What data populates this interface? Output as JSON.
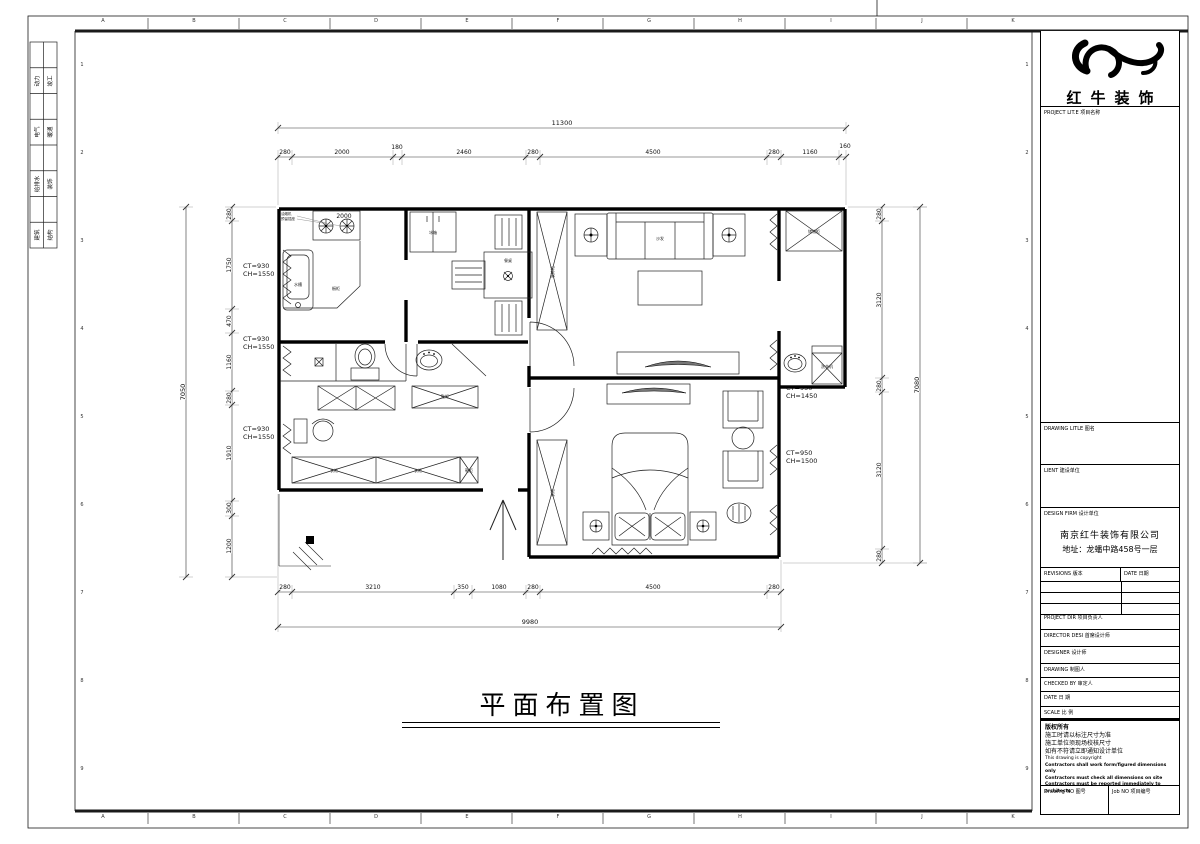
{
  "sheet": {
    "grid_letters": [
      "A",
      "B",
      "C",
      "D",
      "E",
      "F",
      "G",
      "H",
      "I",
      "J",
      "K"
    ],
    "grid_numbers": [
      "1",
      "2",
      "3",
      "4",
      "5",
      "6",
      "7",
      "8",
      "9"
    ],
    "disciplines": [
      {
        "a": "动力",
        "b": "竣工"
      },
      {
        "a": "电气",
        "b": "暖通"
      },
      {
        "a": "给排水",
        "b": "装饰"
      },
      {
        "a": "建筑",
        "b": "结构"
      }
    ]
  },
  "title_block": {
    "company_name": "红牛装饰",
    "project_label": "PROJECT LIT.E  项目名称",
    "drawing_title_label": "DRAWING LITLE  图名",
    "client_label": "LIENT  建设单位",
    "design_firm_label": "DESIGN FIRM  设计单位",
    "firm_name": "南京红牛装饰有限公司",
    "firm_address": "地址：龙蟠中路458号一层",
    "revisions_label": "REVISIONS  版本",
    "revisions_date_label": "DATE  日期",
    "project_dir_label": "PROJECT DIR  项目负责人",
    "director_label": "DIRECTOR DESI  首席设计师",
    "designer_label": "DESIGNER    设计师",
    "drawing_by_label": "DRAWING    制图人",
    "checked_by_label": "CHECKED BY   审定人",
    "date_label": "DATE      日  期",
    "scale_label": "SCALE     比  例",
    "copyright_lines": [
      "版权所有",
      "施工时请以标注尺寸为准",
      "施工单位须现场校核尺寸",
      "如有不符请立即通知设计单位",
      "This drawing is copyright",
      "Contractors shall work form/figured dimensions only",
      "Contractors must check all dimensions on site",
      "Contractors must be reported immediately to architects"
    ],
    "drawing_no_label": "Drawing NO  图号",
    "job_no_label": "Job NO  项目编号"
  },
  "plan": {
    "title": "平面布置图",
    "dims": {
      "top_overall": "11300",
      "top": [
        "280",
        "2000",
        "180",
        "2460",
        "280",
        "4500",
        "280",
        "1160",
        "160"
      ],
      "bottom": [
        "280",
        "3210",
        "350",
        "1080",
        "280",
        "4500",
        "280"
      ],
      "bottom_overall": "9980",
      "left": [
        "280",
        "1750",
        "470",
        "1160",
        "280",
        "1910",
        "300",
        "1200"
      ],
      "left_overall": "7050",
      "right": [
        "280",
        "3120",
        "280",
        "3120",
        "280"
      ],
      "right_overall": "7080",
      "kitchen_counter": "2000"
    },
    "window_tags": [
      {
        "ct": "CT=930",
        "ch": "CH=1550"
      },
      {
        "ct": "CT=930",
        "ch": "CH=1550"
      },
      {
        "ct": "CT=930",
        "ch": "CH=1550"
      },
      {
        "ct": "CT=950",
        "ch": "CH=1450"
      },
      {
        "ct": "CT=950",
        "ch": "CH=1500"
      }
    ],
    "labels": {
      "fridge": "冰箱",
      "dining_table": "餐桌",
      "sofa": "沙发",
      "cabinet_living": "装饰柜",
      "storage": "储物柜",
      "washer": "洗衣机",
      "wardrobe": "衣柜",
      "shoe": "鞋柜",
      "sink": "水槽",
      "counter": "橱柜",
      "note1": "油烟机",
      "note2": "预留插座"
    }
  }
}
